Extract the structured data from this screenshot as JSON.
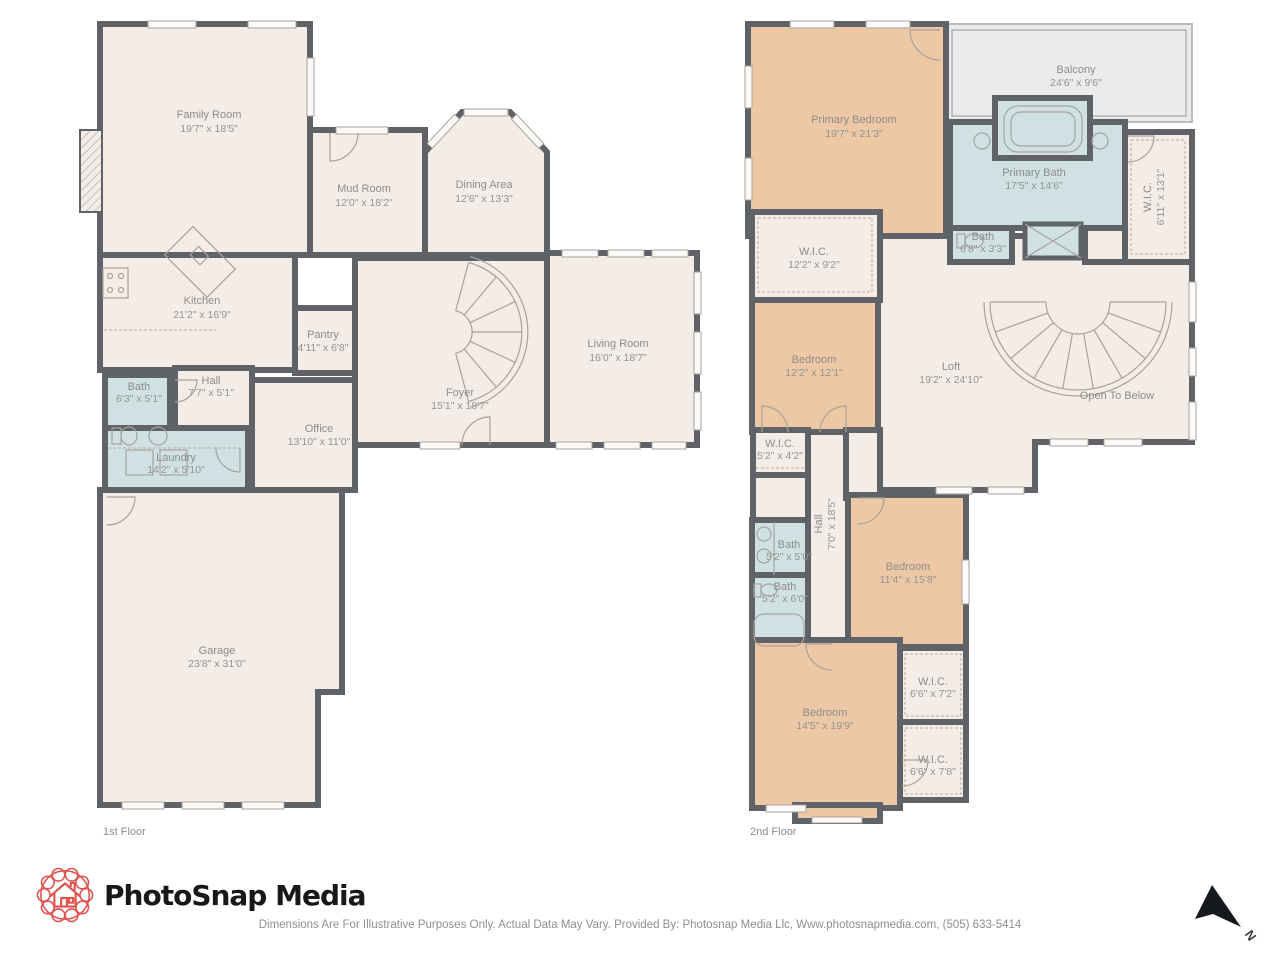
{
  "palette": {
    "wall": "#5f6266",
    "floor": "#f4ece6",
    "bath_blue": "#cfe1e3",
    "bedroom_tan": "#ecc8a5",
    "balcony_gray": "#e9ebed",
    "label_gray": "#8d8d8d",
    "logo_red": "#e0524e",
    "arrow_black": "#15181c"
  },
  "floor1": {
    "label": "1st Floor",
    "rooms": [
      {
        "name": "Family Room",
        "dims": "19'7\" x 18'5\""
      },
      {
        "name": "Mud Room",
        "dims": "12'0\" x 18'2\""
      },
      {
        "name": "Dining Area",
        "dims": "12'6\" x 13'3\""
      },
      {
        "name": "Kitchen",
        "dims": "21'2\" x 16'9\""
      },
      {
        "name": "Pantry",
        "dims": "4'11\" x 6'8\""
      },
      {
        "name": "Living Room",
        "dims": "16'0\" x 18'7\""
      },
      {
        "name": "Foyer",
        "dims": "15'1\" x 18'7\""
      },
      {
        "name": "Hall",
        "dims": "7'7\" x 5'1\""
      },
      {
        "name": "Bath",
        "dims": "6'3\" x 5'1\""
      },
      {
        "name": "Laundry",
        "dims": "14'2\" x 5'10\""
      },
      {
        "name": "Office",
        "dims": "13'10\" x 11'0\""
      },
      {
        "name": "Garage",
        "dims": "23'8\" x 31'0\""
      }
    ]
  },
  "floor2": {
    "label": "2nd Floor",
    "rooms": [
      {
        "name": "Primary Bedroom",
        "dims": "19'7\" x 21'3\""
      },
      {
        "name": "Balcony",
        "dims": "24'6\" x 9'6\""
      },
      {
        "name": "Primary Bath",
        "dims": "17'5\" x 14'6\""
      },
      {
        "name": "W.I.C.",
        "dims": "6'11\" x 13'1\""
      },
      {
        "name": "Bath",
        "dims": "6'8\" x 3'3\""
      },
      {
        "name": "W.I.C.",
        "dims": "12'2\" x 9'2\""
      },
      {
        "name": "Bedroom",
        "dims": "12'2\" x 12'1\""
      },
      {
        "name": "Loft",
        "dims": "19'2\" x 24'10\""
      },
      {
        "name": "Open To Below",
        "dims": ""
      },
      {
        "name": "W.I.C.",
        "dims": "5'2\" x 4'2\""
      },
      {
        "name": "Hall",
        "dims": "7'0\" x 18'5\""
      },
      {
        "name": "Bath",
        "dims": "5'2\" x 5'0\""
      },
      {
        "name": "Bath",
        "dims": "5'2\" x 6'0\""
      },
      {
        "name": "Bedroom",
        "dims": "11'4\" x 15'8\""
      },
      {
        "name": "Bedroom",
        "dims": "14'5\" x 19'9\""
      },
      {
        "name": "W.I.C.",
        "dims": "6'6\" x 7'2\""
      },
      {
        "name": "W.I.C.",
        "dims": "6'6\" x 7'8\""
      }
    ]
  },
  "branding": {
    "logo_text": "PhotoSnap Media"
  },
  "footer": {
    "disclaimer": "Dimensions Are For Illustrative Purposes Only. Actual Data May Vary. Provided By: Photosnap Media Llc, Www.photosnapmedia.com, (505) 633-5414"
  },
  "compass": {
    "label": "N"
  }
}
